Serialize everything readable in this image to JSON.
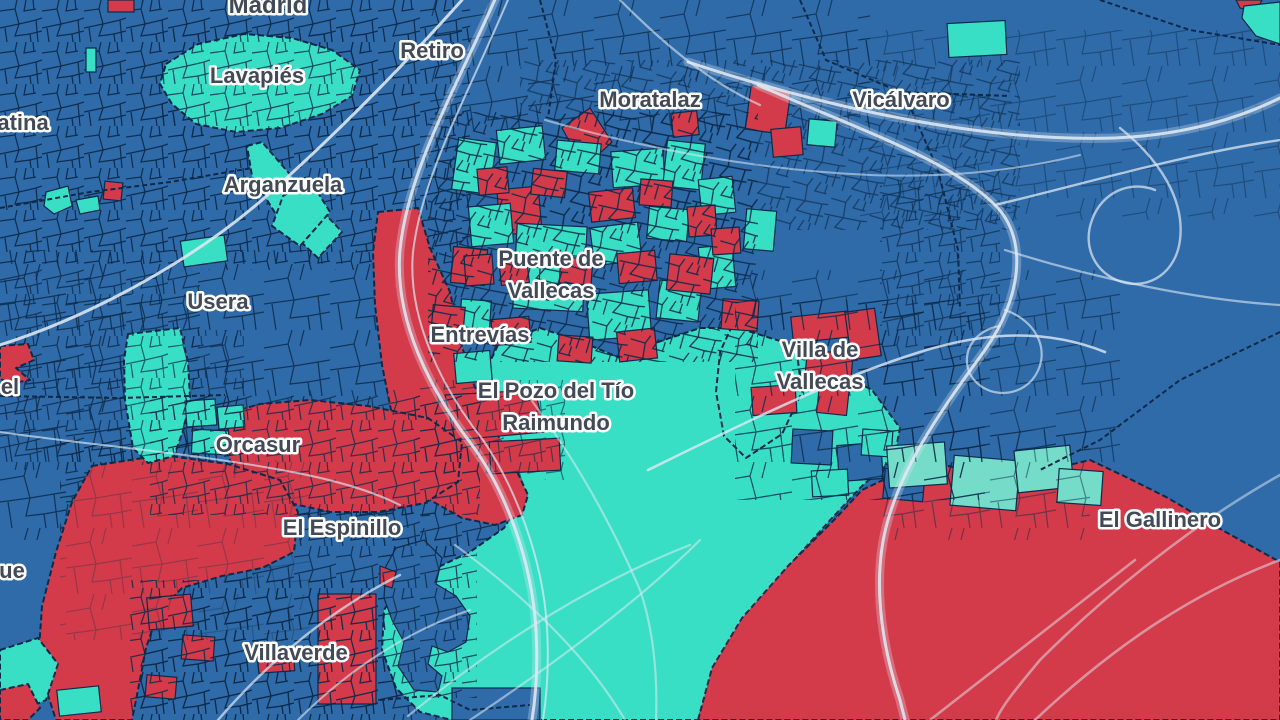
{
  "map": {
    "colors": {
      "parcel_blue": "#2F6BA9",
      "parcel_teal": "#38DFC4",
      "parcel_teal_light": "#74DCC8",
      "parcel_red": "#D43B4A",
      "border_dark": "#0C2A4A",
      "road_light": "#DFE9F4",
      "label_text": "#424957",
      "label_halo": "#FFFFFF"
    },
    "labels": [
      {
        "name": "madrid",
        "text": "Madrid",
        "x": 268,
        "y": 13,
        "size": 24
      },
      {
        "name": "lavapies",
        "text": "Lavapiés",
        "x": 257,
        "y": 83
      },
      {
        "name": "retiro",
        "text": "Retiro",
        "x": 432,
        "y": 58
      },
      {
        "name": "moratalaz",
        "text": "Moratalaz",
        "x": 650,
        "y": 107
      },
      {
        "name": "vicalvaro",
        "text": "Vicálvaro",
        "x": 901,
        "y": 107
      },
      {
        "name": "latina-partial",
        "text": "atina",
        "x": 23,
        "y": 130
      },
      {
        "name": "arganzuela",
        "text": "Arganzuela",
        "x": 283,
        "y": 192
      },
      {
        "name": "usera",
        "text": "Usera",
        "x": 218,
        "y": 309
      },
      {
        "name": "puente-de-vallecas",
        "lines": [
          "Puente de",
          "Vallecas"
        ],
        "x": 551,
        "y": 266
      },
      {
        "name": "entrevias",
        "text": "Entrevías",
        "x": 480,
        "y": 342
      },
      {
        "name": "villa-de-vallecas",
        "lines": [
          "Villa de",
          "Vallecas"
        ],
        "x": 820,
        "y": 357
      },
      {
        "name": "el-pozo-del-tio-raimundo",
        "lines": [
          "El Pozo del Tío",
          "Raimundo"
        ],
        "x": 556,
        "y": 398
      },
      {
        "name": "left-edge-partial-el",
        "text": "el",
        "x": 10,
        "y": 394
      },
      {
        "name": "orcasur",
        "text": "Orcasur",
        "x": 258,
        "y": 452
      },
      {
        "name": "el-espinillo",
        "text": "El Espinillo",
        "x": 342,
        "y": 535
      },
      {
        "name": "left-edge-partial-ue",
        "text": "ue",
        "x": 12,
        "y": 578
      },
      {
        "name": "el-gallinero",
        "text": "El Gallinero",
        "x": 1160,
        "y": 527
      },
      {
        "name": "villaverde",
        "text": "Villaverde",
        "x": 296,
        "y": 660
      }
    ]
  }
}
